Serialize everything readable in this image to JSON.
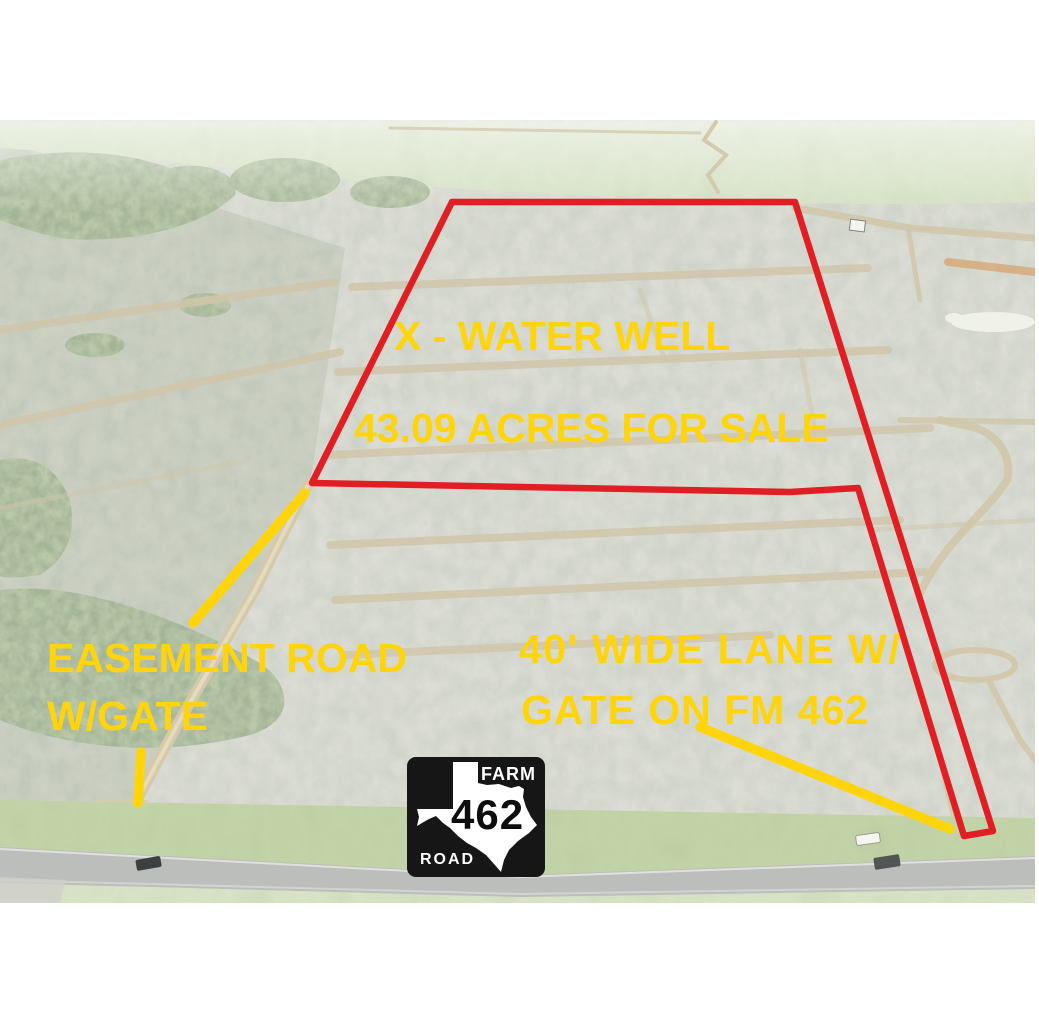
{
  "annotations": {
    "water_well": "X - WATER WELL",
    "acreage": "43.09 ACRES FOR SALE",
    "easement": {
      "line1": "EASEMENT ROAD",
      "line2": "W/GATE"
    },
    "lane": {
      "line1": "40' WIDE LANE W/",
      "line2": "GATE ON FM 462"
    }
  },
  "road_sign": {
    "top": "FARM",
    "number": "462",
    "bottom": "ROAD"
  },
  "colors": {
    "annotation_yellow": "#FFD40A",
    "boundary_red": "#E01E24",
    "sign_black": "#161616",
    "sign_white": "#FFFFFF"
  }
}
